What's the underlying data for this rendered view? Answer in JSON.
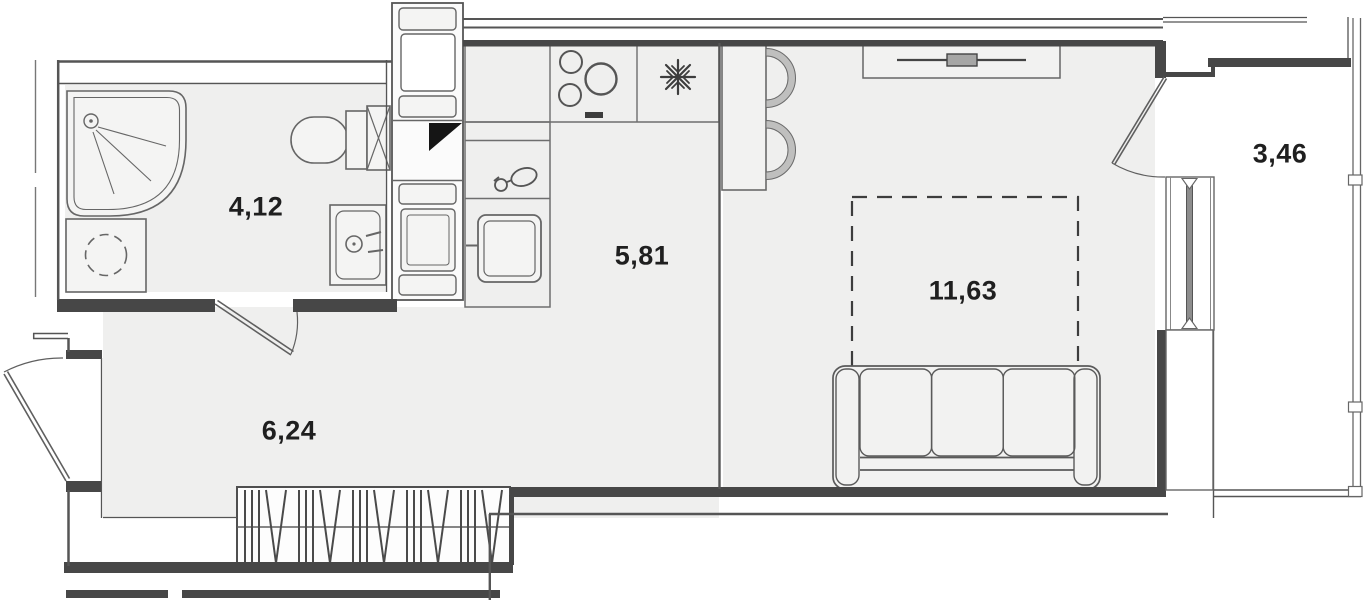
{
  "floorplan": {
    "title": "studio-apartment-floor-plan",
    "rooms": [
      {
        "name": "bathroom",
        "area": "4,12"
      },
      {
        "name": "kitchen",
        "area": "5,81"
      },
      {
        "name": "hallway",
        "area": "6,24"
      },
      {
        "name": "living-room",
        "area": "11,63"
      },
      {
        "name": "balcony",
        "area": "3,46"
      }
    ],
    "fixtures": [
      "shower-cabin",
      "washing-machine",
      "toilet",
      "bathroom-sink",
      "ventilation-shaft",
      "utility-column-cabinets",
      "kitchen-counter",
      "stove-burners",
      "refrigerator-snowflake",
      "kitchen-tap",
      "kitchen-appliance",
      "bar-counter",
      "bar-stool",
      "tv-stand",
      "bed-zone-dashed",
      "sofa",
      "wardrobe-hangers",
      "entrance-door",
      "bathroom-door",
      "balcony-door",
      "balcony-window",
      "balcony-glazing"
    ],
    "colors": {
      "wall": "#474747",
      "line": "#5f5f5f",
      "thin_line": "#6e6e6e",
      "floor": "#efefee",
      "fixture_fill": "#f4f4f3",
      "label": "#1f1f1f",
      "duct_mark": "#151515"
    }
  }
}
